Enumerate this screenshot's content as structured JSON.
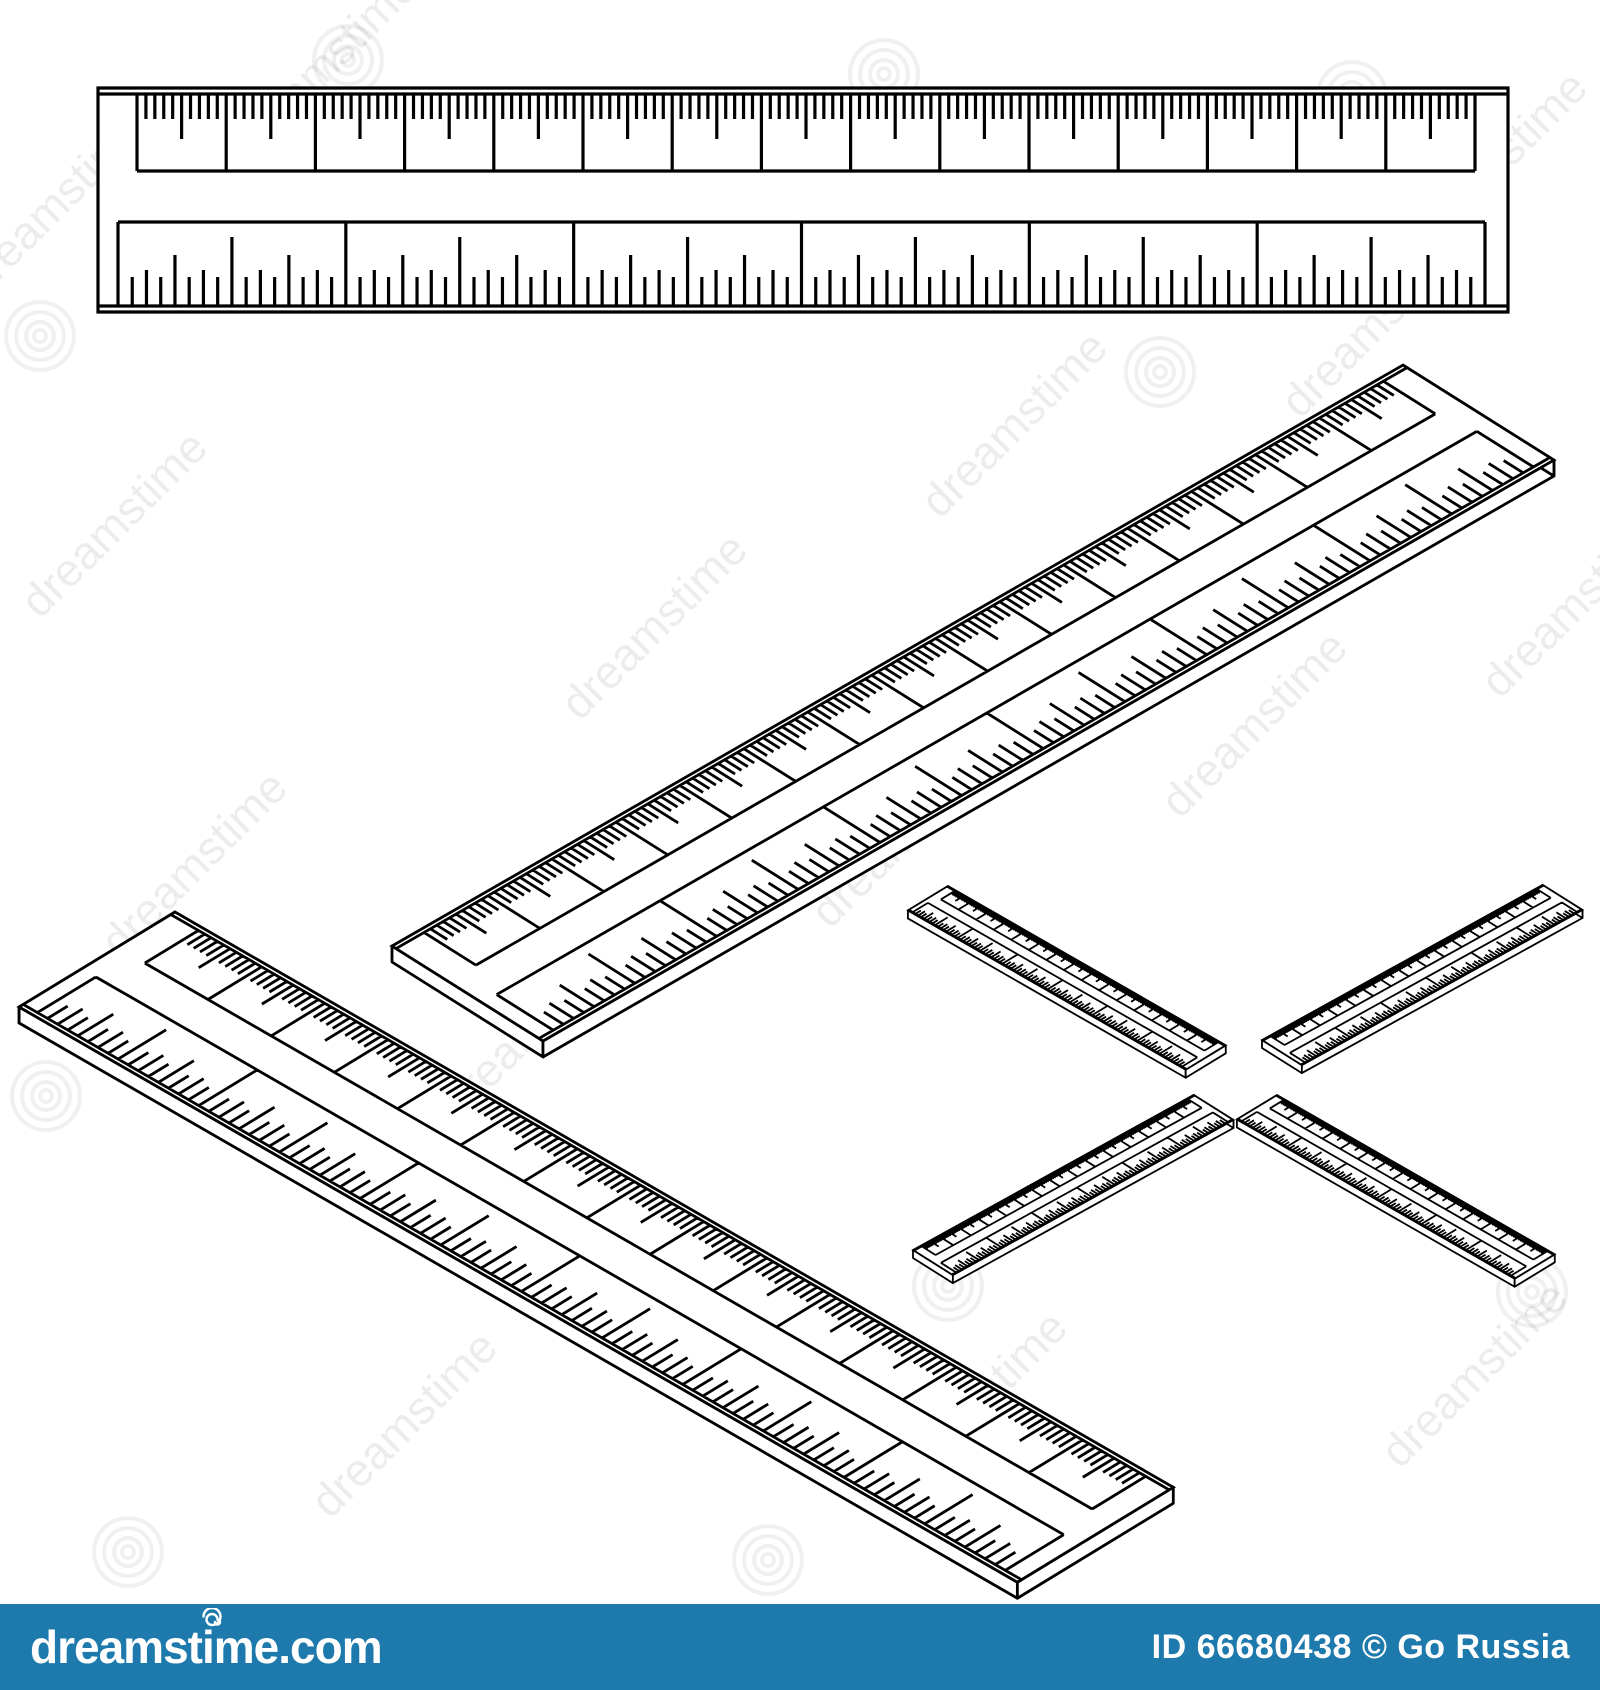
{
  "image": {
    "width": 1600,
    "height": 1690,
    "background_color": "#ffffff",
    "line_color": "#000000"
  },
  "watermark": {
    "ghost_text": "dreamstime",
    "bar": {
      "site": "dreamstime.com",
      "credit": "ID 66680438 © Go  Russia",
      "bg_color": "#1e7aad",
      "text_color": "#ffffff"
    }
  },
  "ruler_design": {
    "width": 1410,
    "height": 224,
    "inner_line_inset": 6,
    "top_scale": {
      "x_start": 39,
      "x_end": 1377,
      "y_top": 6,
      "y_bottom": 83,
      "cm_divisions": 15,
      "mm_per_cm": 10,
      "mm_tick_len": 25,
      "half_cm_tick_len": 45
    },
    "bottom_scale": {
      "x_start": 20,
      "x_end": 1387,
      "y_top": 134,
      "y_bottom": 218,
      "inch_divisions": 6,
      "ticks_per_inch": 16,
      "tick_len_half": 69,
      "tick_len_quarter": 51,
      "tick_len_eighth": 36,
      "tick_len_sixteenth": 29
    }
  },
  "rulers": [
    {
      "name": "flat-ruler",
      "matrix": [
        1,
        0,
        0,
        1,
        98,
        88
      ],
      "thickness": 0,
      "stroke": 3.2
    },
    {
      "name": "iso-ruler-middle",
      "matrix": [
        0.717,
        -0.412,
        0.674,
        0.424,
        392,
        946
      ],
      "thickness": 16,
      "stroke": 2.8
    },
    {
      "name": "iso-ruler-lower-left",
      "matrix": [
        0.708,
        0.408,
        -0.696,
        0.424,
        175,
        912
      ],
      "thickness": 16,
      "stroke": 2.8
    },
    {
      "name": "small-ruler-nw",
      "matrix": [
        0.197,
        0.113,
        -0.179,
        0.109,
        948,
        886
      ],
      "thickness": 8,
      "stroke": 1.8
    },
    {
      "name": "small-ruler-ne",
      "matrix": [
        0.199,
        -0.11,
        0.178,
        0.112,
        1262,
        1040
      ],
      "thickness": 8,
      "stroke": 1.8
    },
    {
      "name": "small-ruler-sw",
      "matrix": [
        0.199,
        -0.11,
        0.178,
        0.112,
        913,
        1250
      ],
      "thickness": 8,
      "stroke": 1.8
    },
    {
      "name": "small-ruler-se",
      "matrix": [
        0.197,
        0.113,
        -0.179,
        0.109,
        1277,
        1095
      ],
      "thickness": 8,
      "stroke": 1.8
    }
  ]
}
